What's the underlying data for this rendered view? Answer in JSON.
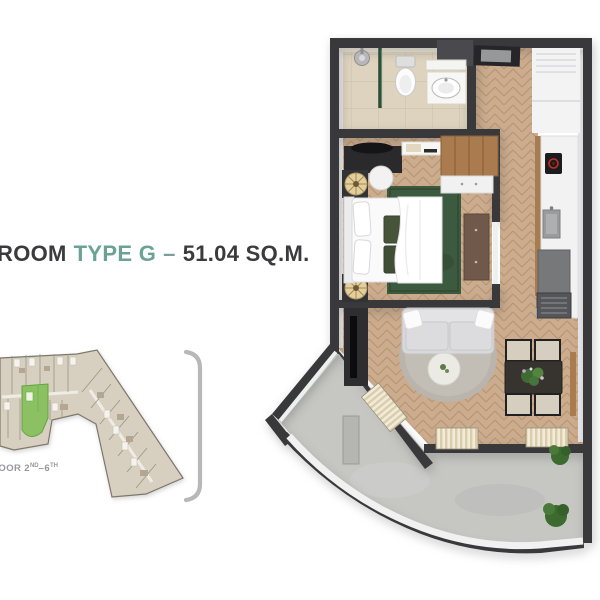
{
  "title": {
    "room_prefix": "ROOM",
    "type_label": "TYPE G",
    "separator": "–",
    "area_label": "51.04 SQ.M."
  },
  "mini_map": {
    "floor_label_pre": "FLOOR 2",
    "floor_label_sup1": "ND",
    "floor_label_mid": "–6",
    "floor_label_sup2": "TH"
  },
  "colors": {
    "accent_teal": "#6ba296",
    "wall_dark": "#39393b",
    "wood_floor": "#cbac8e",
    "tile_floor": "#ddd3be",
    "concrete": "#c6c7c3",
    "highlight_green": "#8bc163",
    "rug_green": "#3c5a40",
    "bracket_gray": "#b8b8ba"
  }
}
